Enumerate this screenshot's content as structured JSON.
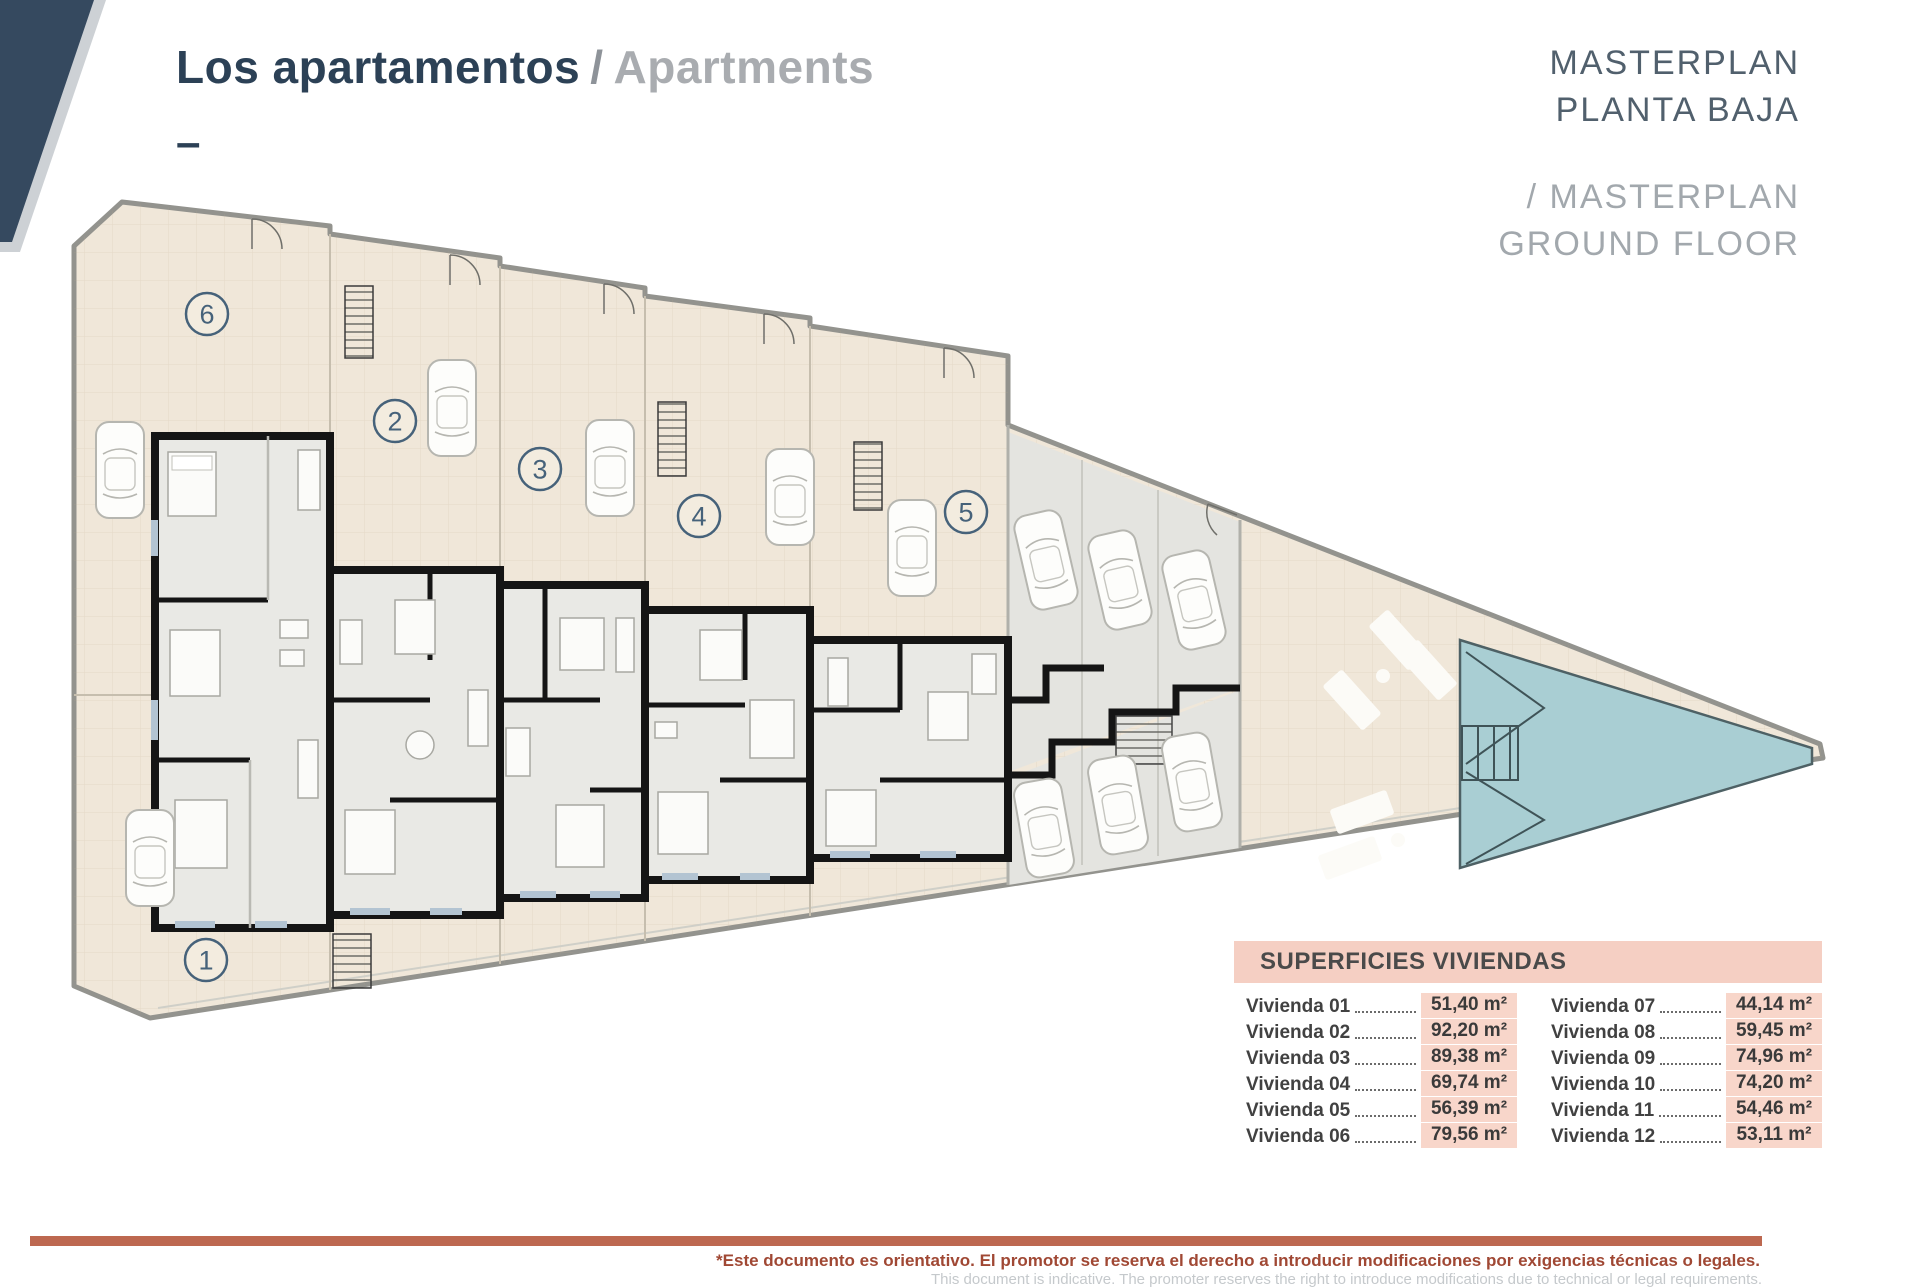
{
  "header": {
    "title_primary": "Los apartamentos",
    "title_separator": "/",
    "title_secondary": "Apartments",
    "dash": "–"
  },
  "masterplan": {
    "line1": "MASTERPLAN",
    "line2": "PLANTA BAJA",
    "line3": "/ MASTERPLAN",
    "line4": "GROUND FLOOR"
  },
  "plan": {
    "units": [
      "6",
      "2",
      "3",
      "4",
      "5",
      "1"
    ]
  },
  "table": {
    "title": "SUPERFICIES VIVIENDAS",
    "columns": [
      {
        "rows": [
          {
            "label": "Vivienda 01",
            "value": "51,40 m²"
          },
          {
            "label": "Vivienda 02",
            "value": "92,20 m²"
          },
          {
            "label": "Vivienda 03",
            "value": "89,38 m²"
          },
          {
            "label": "Vivienda 04",
            "value": "69,74 m²"
          },
          {
            "label": "Vivienda 05",
            "value": "56,39 m²"
          },
          {
            "label": "Vivienda 06",
            "value": "79,56 m²"
          }
        ]
      },
      {
        "rows": [
          {
            "label": "Vivienda 07",
            "value": "44,14 m²"
          },
          {
            "label": "Vivienda 08",
            "value": "59,45 m²"
          },
          {
            "label": "Vivienda 09",
            "value": "74,96 m²"
          },
          {
            "label": "Vivienda 10",
            "value": "74,20 m²"
          },
          {
            "label": "Vivienda 11",
            "value": "54,46 m²"
          },
          {
            "label": "Vivienda 12",
            "value": "53,11 m²"
          }
        ]
      }
    ]
  },
  "footer": {
    "line_es": "*Este documento es orientativo. El promotor se reserva el derecho a introducir modificaciones por exigencias técnicas o legales.",
    "line_en": "This document is indicative. The promoter reserves the right to introduce modifications due to technical or legal requirements."
  },
  "colors": {
    "accent_navy": "#2c4156",
    "accent_terracotta": "#bd6850",
    "table_pink": "#f5cfc3",
    "pool_teal": "#a9ced3",
    "patio_beige": "#f0e7d9"
  }
}
